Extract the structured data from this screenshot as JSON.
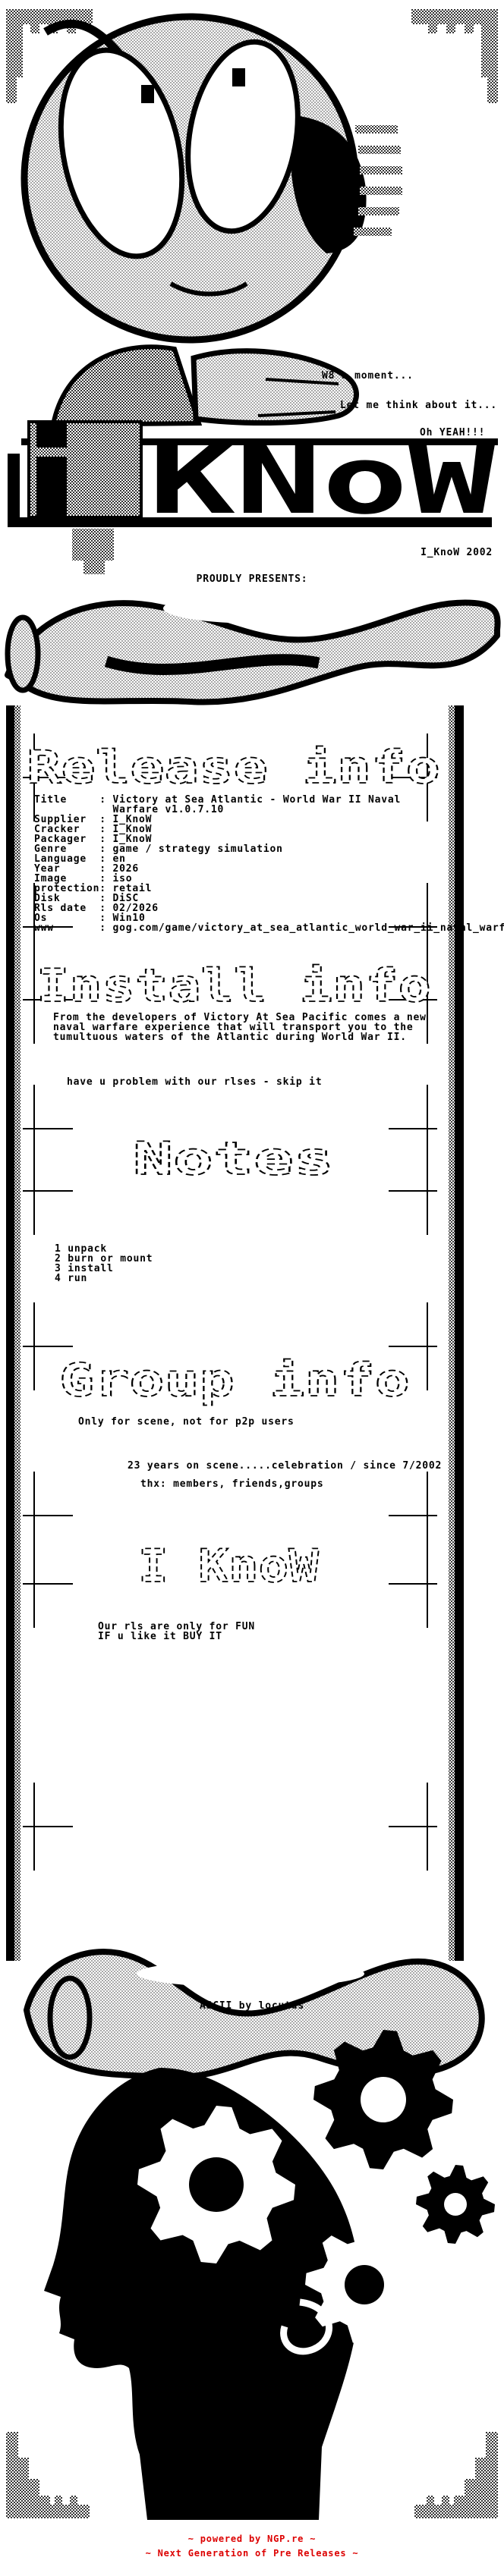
{
  "speech": {
    "line1": "W8 a moment...",
    "line2": "Let me think about it...",
    "line3": "Oh YEAH!!!"
  },
  "logo": {
    "i": "i",
    "know": "KNoW",
    "tag": "I_KnoW 2002",
    "presents": "PROUDLY PRESENTS:"
  },
  "sections": {
    "release": {
      "title": "Release info",
      "fields": "Title     : Victory at Sea Atlantic - World War II Naval\n            Warfare v1.0.7.10\nSupplier  : I_KnoW\nCracker   : I_KnoW\nPackager  : I_KnoW\nGenre     : game / strategy simulation\nLanguage  : en\nYear      : 2026\nImage     : iso\nprotection: retail\nDisk      : DiSC\nRls date  : 02/2026\nOs        : Win10\nwww       : gog.com/game/victory_at_sea_atlantic_world_war_ii_naval_warfare"
    },
    "install": {
      "title": "Install info",
      "body": "From the developers of Victory At Sea Pacific comes a new\nnaval warfare experience that will transport you to the\ntumultuous waters of the Atlantic during World War II.",
      "note": "have u problem with our rlses - skip it"
    },
    "notes": {
      "title": "Notes",
      "steps": "1 unpack\n2 burn or mount\n3 install\n4 run"
    },
    "group": {
      "title": "Group info",
      "line1": "Only for scene, not for p2p users",
      "line2": "23 years on scene.....celebration / since 7/2002",
      "line3": "thx: members, friends,groups"
    },
    "iknow": {
      "title": "I KnoW",
      "lines": "Our rls are only for FUN\nIF u like it BUY IT"
    }
  },
  "credit": "ASCII by locutus",
  "footer": {
    "color": "#dd0000",
    "line1": "~ powered by NGP.re ~",
    "line2": "~ Next Generation of Pre Releases ~"
  }
}
